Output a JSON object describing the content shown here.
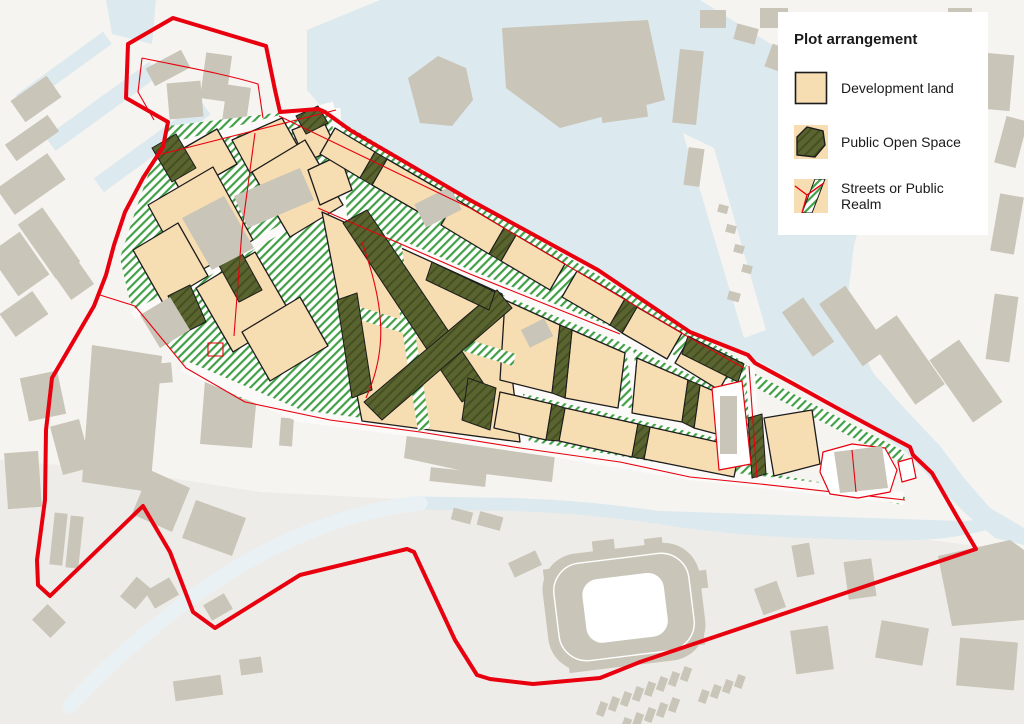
{
  "legend": {
    "title": "Plot arrangement",
    "items": [
      {
        "id": "development-land",
        "label": "Development land"
      },
      {
        "id": "public-open-space",
        "label": "Public Open Space"
      },
      {
        "id": "streets-public-realm",
        "label": "Streets or Public Realm"
      }
    ]
  },
  "palette": {
    "red": "#e8000f",
    "tan": "#f7ddb2",
    "olive": "#5a6430",
    "olive_dark": "#454f1f",
    "street_green": "#43a047",
    "building": "#c9c5b8",
    "water": "#dce9ee",
    "water_faint": "#e9f1f5",
    "paper": "#fbfaf8",
    "background": "#f6f4f1",
    "ink": "#1c1c1c",
    "text": "#1a1a1a"
  }
}
